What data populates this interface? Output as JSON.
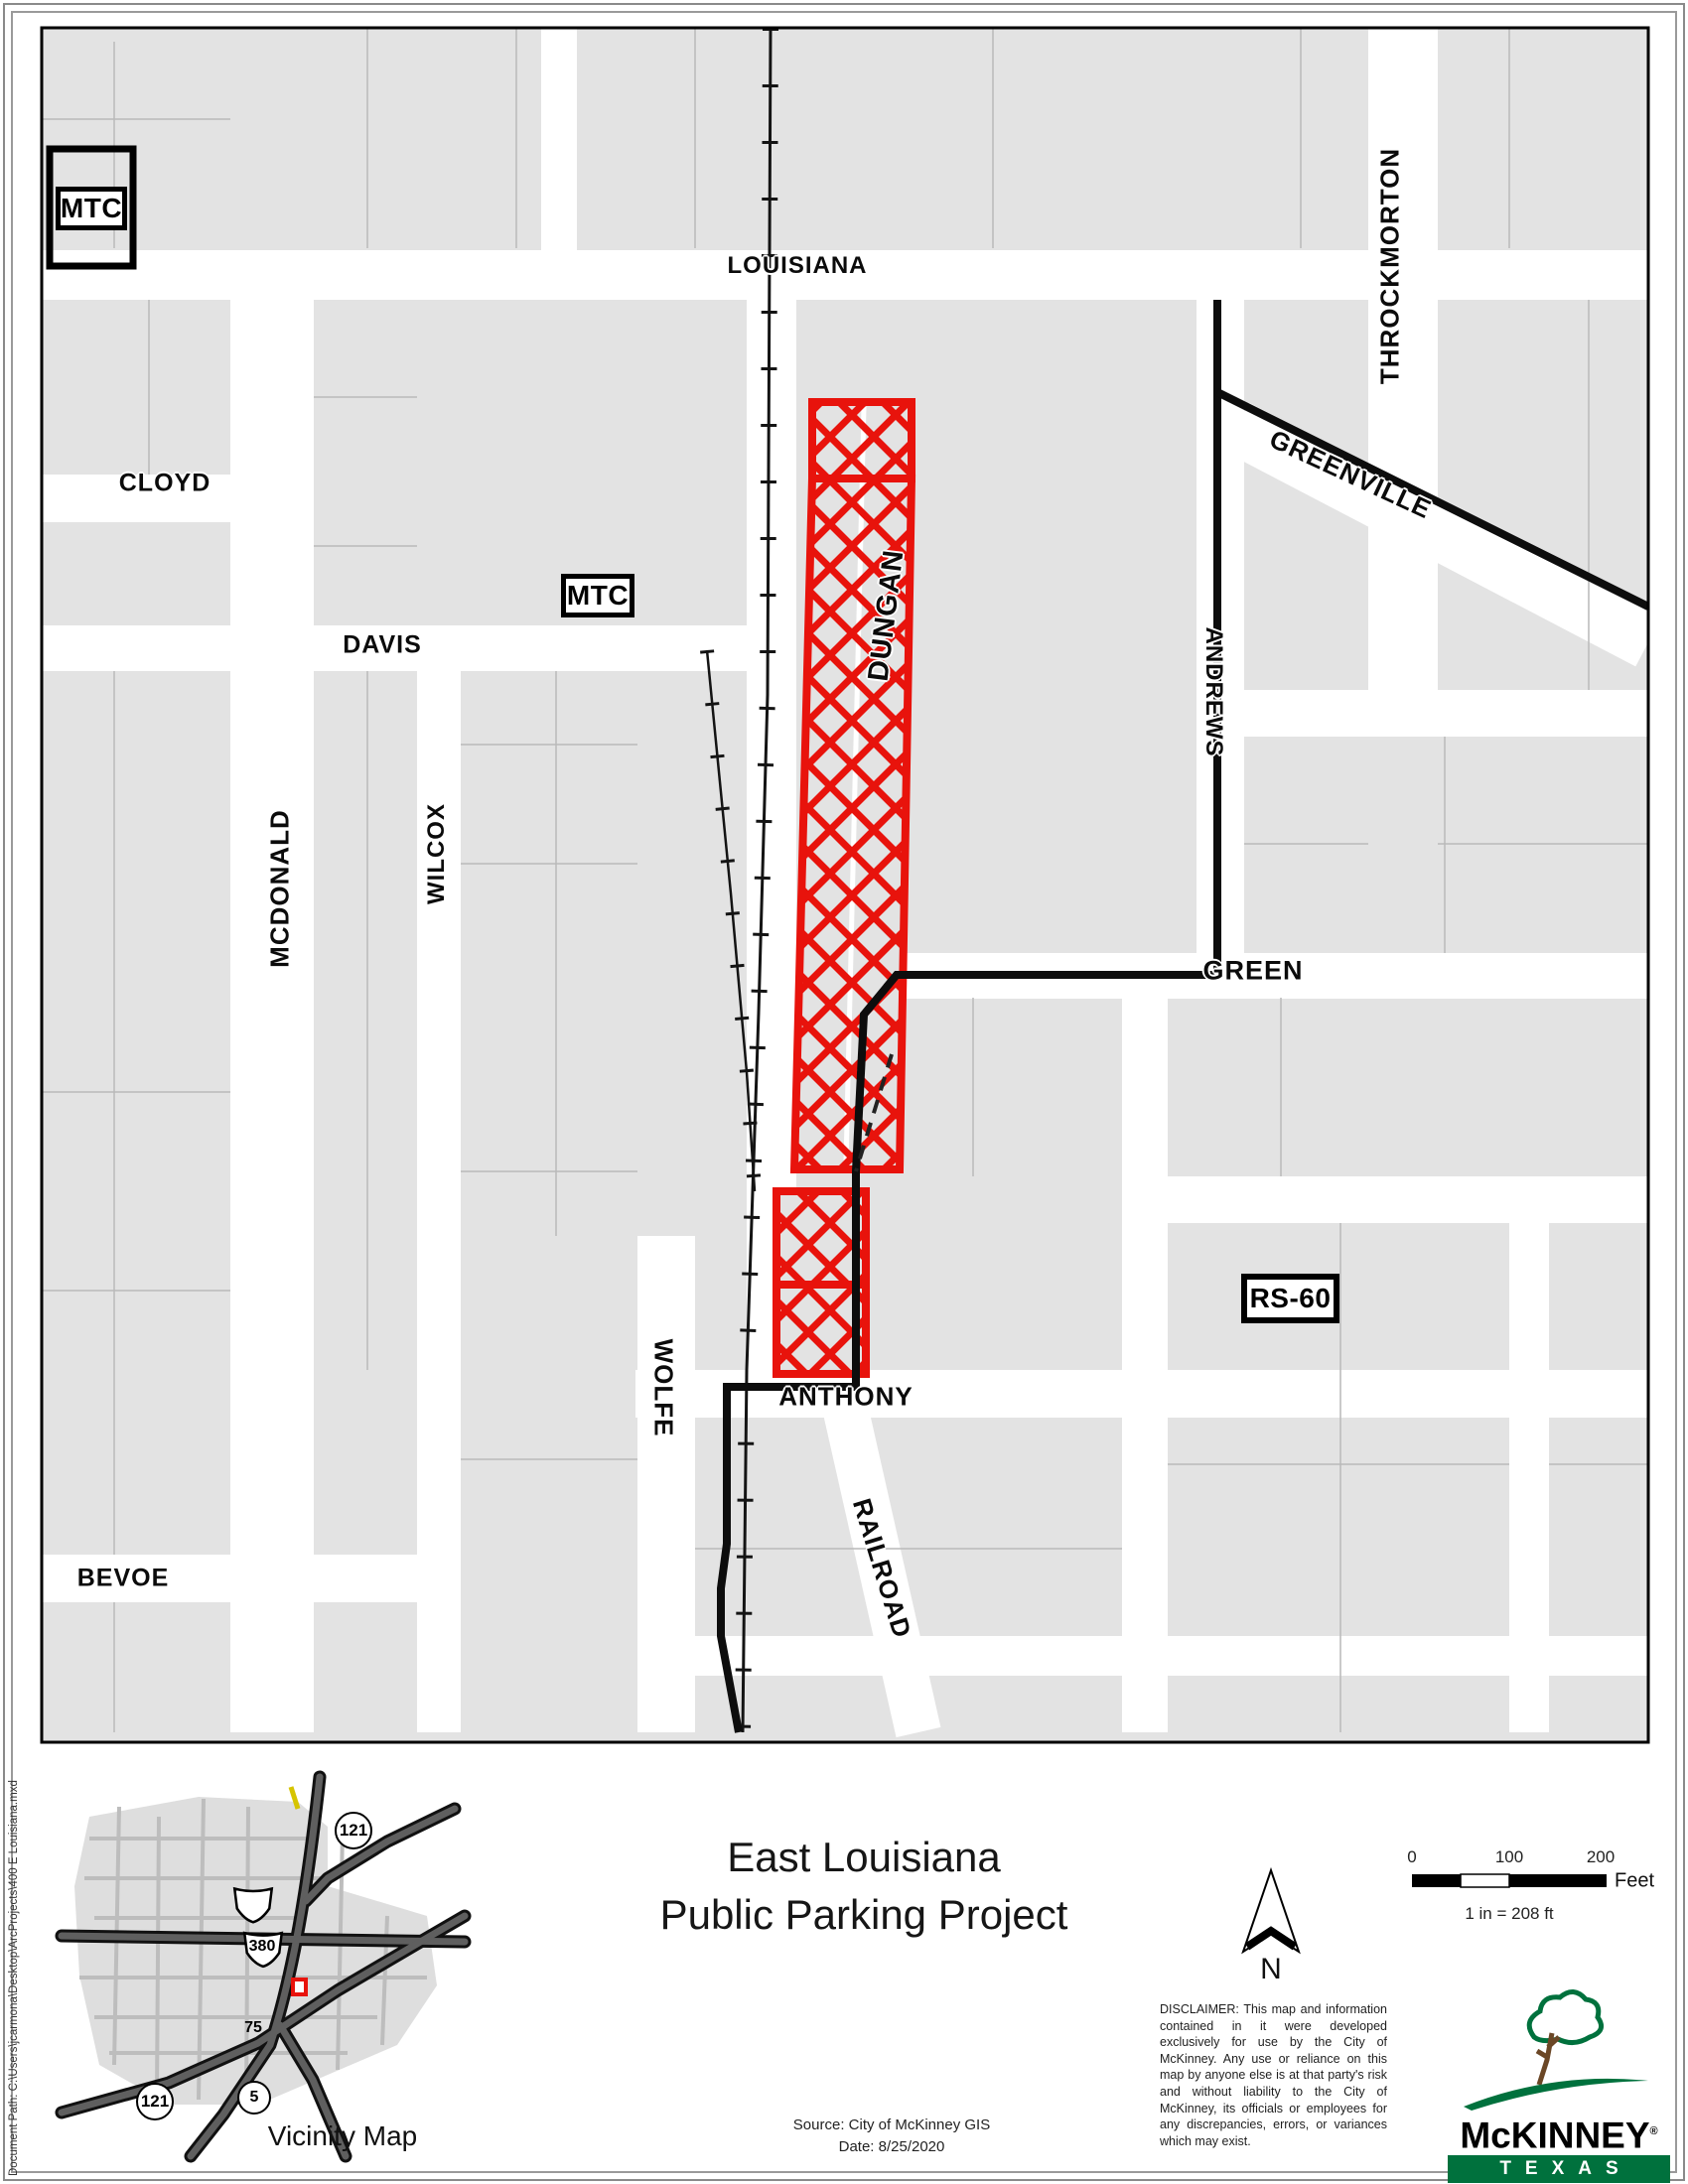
{
  "map": {
    "streets": {
      "louisiana": "LOUISIANA",
      "cloyd": "CLOYD",
      "davis": "DAVIS",
      "mcdonald": "MCDONALD",
      "wilcox": "WILCOX",
      "bevoe": "BEVOE",
      "wolfe": "WOLFE",
      "anthony": "ANTHONY",
      "railroad": "RAILROAD",
      "dungan": "DUNGAN",
      "green": "GREEN",
      "andrews": "ANDREWS",
      "greenville": "GREENVILLE",
      "throckmorton": "THROCKMORTON"
    },
    "zones": {
      "mtc_upper": "MTC",
      "mtc_lower": "MTC",
      "rs60": "RS-60"
    }
  },
  "titleblock": {
    "line1": "East Louisiana",
    "line2": "Public Parking Project"
  },
  "north": {
    "label": "N"
  },
  "scalebar": {
    "tick0": "0",
    "tick100": "100",
    "tick200": "200",
    "unit": "Feet",
    "ratio": "1 in = 208 ft"
  },
  "vicinity": {
    "caption": "Vicinity Map",
    "shield_121_ne": "121",
    "shield_380": "380",
    "shield_75": "75",
    "shield_5": "5",
    "shield_121_sw": "121"
  },
  "notes": {
    "disclaimer": "DISCLAIMER: This map and information contained in it were developed exclusively for use by the City of McKinney. Any use or reliance on this map by anyone else is at that party's risk and without liability to the City of McKinney, its officials or employees for any discrepancies, errors, or variances which may exist.",
    "source_line1": "Source: City of McKinney GIS",
    "source_line2": "Date: 8/25/2020",
    "document_path": "Document Path: C:\\Users\\jcarmona\\Desktop\\ArcProjects\\400 E Louisiana.mxd"
  },
  "logo": {
    "city": "McKINNEY",
    "registered": "®",
    "state": "TEXAS",
    "tagline": "Unique by nature."
  },
  "colors": {
    "project_red": "#e8130c",
    "logo_green": "#00713d",
    "logo_brown": "#5d4a36",
    "parcel_gray": "#e3e3e3"
  }
}
